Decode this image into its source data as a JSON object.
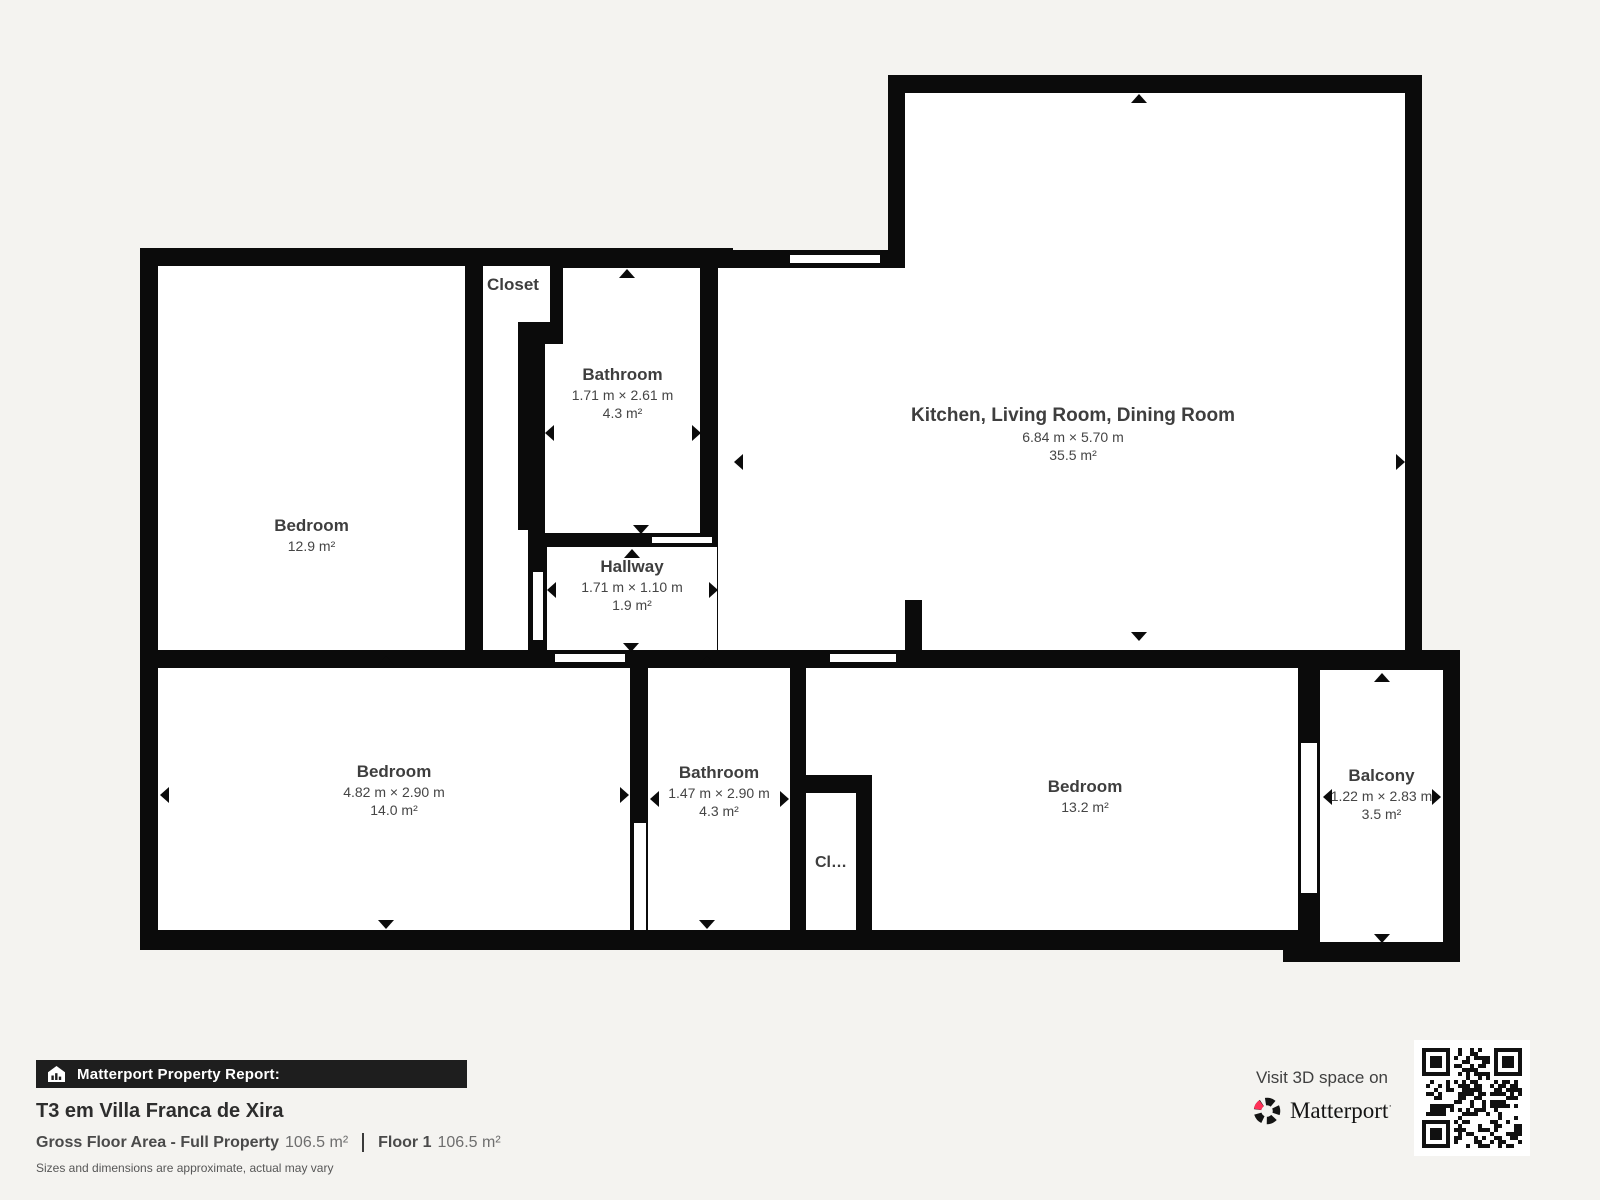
{
  "floorplan": {
    "rooms": [
      {
        "name": "Bedroom",
        "area": "12.9 m²"
      },
      {
        "name": "Closet"
      },
      {
        "name": "Bathroom",
        "dims": "1.71 m × 2.61 m",
        "area": "4.3 m²"
      },
      {
        "name": "Kitchen, Living Room, Dining Room",
        "dims": "6.84 m × 5.70 m",
        "area": "35.5 m²"
      },
      {
        "name": "Hallway",
        "dims": "1.71 m × 1.10 m",
        "area": "1.9 m²"
      },
      {
        "name": "Bedroom",
        "dims": "4.82 m × 2.90 m",
        "area": "14.0 m²"
      },
      {
        "name": "Bathroom",
        "dims": "1.47 m × 2.90 m",
        "area": "4.3 m²"
      },
      {
        "name": "Cl…"
      },
      {
        "name": "Bedroom",
        "area": "13.2 m²"
      },
      {
        "name": "Balcony",
        "dims": "1.22 m × 2.83 m",
        "area": "3.5 m²"
      }
    ],
    "colors": {
      "wall": "#0b0b0b",
      "room_fill": "#ffffff",
      "background": "#f4f3f0"
    }
  },
  "footer": {
    "report_label": "Matterport Property Report:",
    "title": "T3 em Villa Franca de Xira",
    "gfa_label": "Gross Floor Area - Full Property",
    "gfa_value": "106.5 m²",
    "floor_label": "Floor 1",
    "floor_value": "106.5 m²",
    "disclaimer": "Sizes and dimensions are approximate, actual may vary",
    "visit_text": "Visit 3D space on",
    "brand": "Matterport",
    "colors": {
      "accent": "#ff3158",
      "bar_bg": "#1e1e1e"
    }
  }
}
